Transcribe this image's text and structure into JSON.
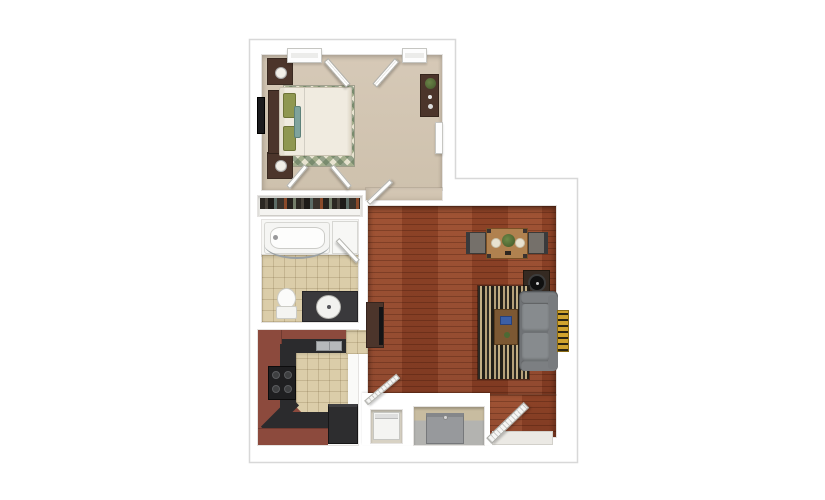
{
  "meta": {
    "description": "3D top-down rendering of a one-bedroom apartment floor plan on a white background",
    "visible_text": "none"
  },
  "colors": {
    "wall": "#ffffff",
    "outline": "#d8d8d8",
    "carpet": "#d6c9b7",
    "carpet2": "#cec1ad",
    "wood": "#9a4a2b",
    "wood2": "#8a4026",
    "tile": "#dbcda9",
    "bathwhite": "#f7f7f5",
    "cabinet": "#8c4a3d",
    "cabinetdark": "#703a30",
    "counter": "#2b2b2d",
    "rugcream": "#e6e2d0",
    "stripedark": "#2e2a23",
    "stripetan": "#c2ae84",
    "sofaframe": "#6f7275",
    "sofacushion": "#878b8e",
    "darkwood": "#4c352b",
    "gold": "#d1a42e",
    "fridge": "#2d2d2f",
    "appliance": "#97999c",
    "duvet": "#f0ebe0",
    "pillow": "#8f9751"
  },
  "rooms": [
    {
      "id": "bedroom",
      "name": "Bedroom",
      "furniture": [
        "bed with cream duvet",
        "green pillows",
        "two nightstands with lamps",
        "wall-mounted tv",
        "green diamond rug",
        "dresser with plant",
        "two windows",
        "open double casement window"
      ]
    },
    {
      "id": "bedroom-closet",
      "name": "Bedroom closet",
      "furniture": [
        "hanging clothes",
        "shelf",
        "double swing doors"
      ]
    },
    {
      "id": "bathroom",
      "name": "Bathroom",
      "furniture": [
        "bathtub with curved shower rod",
        "linen cabinet",
        "toilet",
        "dark vanity with oval sink"
      ]
    },
    {
      "id": "kitchen",
      "name": "Kitchen",
      "furniture": [
        "u-shaped red-brown cabinets",
        "black countertop",
        "sink",
        "range with burners",
        "refrigerator"
      ]
    },
    {
      "id": "living-dining",
      "name": "Living / dining room",
      "furniture": [
        "dining table with plant and plates",
        "two dining chairs",
        "record-player side table",
        "gray sofa",
        "striped rug",
        "coffee table",
        "media console with tv",
        "gold wall art"
      ]
    },
    {
      "id": "laundry-closet",
      "name": "Laundry closet",
      "furniture": [
        "washer",
        "louvered door"
      ]
    },
    {
      "id": "utility-closet",
      "name": "Utility closet",
      "furniture": [
        "utility unit"
      ]
    },
    {
      "id": "entry",
      "name": "Entry",
      "furniture": [
        "open louvered front door",
        "tile threshold"
      ]
    }
  ]
}
